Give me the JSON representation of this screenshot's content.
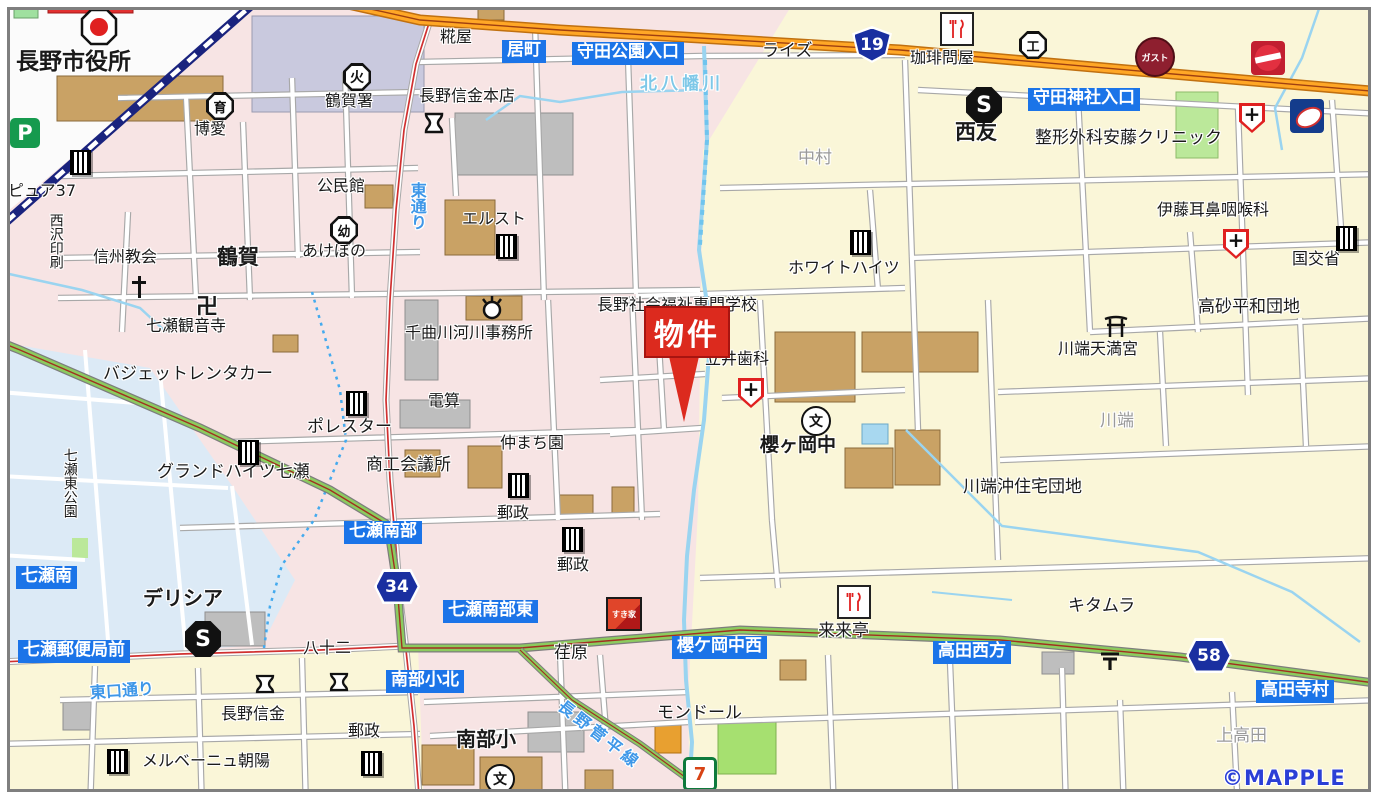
{
  "attribution": "©MAPPLE",
  "marker": {
    "label": "物件"
  },
  "colors": {
    "urban_pink": "#F7E4E4",
    "suburb_yellow": "#FAF6D8",
    "water_blue": "#DCEAF6",
    "park_green": "#BBE89A",
    "major_road_orange": "#FFA726",
    "green_road": "#8CCB5E",
    "badge_blue": "#1B74E8",
    "marker_red": "#DC2A1E",
    "river": "#9AD4F0"
  },
  "shields": {
    "r19": "19",
    "r34": "34",
    "r58": "58"
  },
  "badges": {
    "imachi": "居町",
    "morita_koen": "守田公園入口",
    "morita_jinja": "守田神社入口",
    "nanase_nanbu": "七瀬南部",
    "nanase_nanbu_higashi": "七瀬南部東",
    "nanbu_sho_kita": "南部小北",
    "nanase_minami": "七瀬南",
    "nanase_yubinkyoku_mae": "七瀬郵便局前",
    "sakuragaoka_nishi": "櫻ケ岡中西",
    "takada_seiho": "高田西方",
    "takada_teramura": "高田寺村"
  },
  "roads": {
    "higashi_dori": "東通り",
    "higashiguchi_dori": "東口通り",
    "sugadaira": "長野菅平線"
  },
  "river": {
    "kitahachiman": "北八幡川"
  },
  "areas": {
    "tsuruga": "鶴賀",
    "nakamura": "中村",
    "kawabata": "川端",
    "kamitakada": "上高田"
  },
  "places": {
    "nagano_shiyakusho": "長野市役所",
    "tsuruga_sho": "鶴賀署",
    "hakuai": "博愛",
    "kominkan": "公民館",
    "akebono": "あけぼの",
    "shinshu_kyokai": "信州教会",
    "nishizawa_insatsu": "西沢印刷",
    "nanase_kannonji": "七瀬観音寺",
    "kojiya": "糀屋",
    "shinkin_honten": "長野信金本店",
    "erusuto": "エルスト",
    "pure37": "ピュア37",
    "budget": "バジェットレンタカー",
    "polestar": "ポレスター",
    "grand_heights": "グランドハイツ七瀬",
    "shoko": "商工会議所",
    "chikuma": "千曲川河川事務所",
    "densan": "電算",
    "nakamachien": "仲まち園",
    "yusei": "郵政",
    "senmon": "長野社会福祉専門学校",
    "tatei": "立井歯科",
    "sakuragaoka_chu": "櫻ヶ岡中",
    "white_heights": "ホワイトハイツ",
    "rise": "ライズ",
    "coffee": "珈琲問屋",
    "seiyu": "西友",
    "ando": "整形外科安藤クリニック",
    "ito": "伊藤耳鼻咽喉科",
    "kokkosho": "国交省",
    "takasago": "高砂平和団地",
    "tenmangu": "川端天満宮",
    "kawabataoki": "川端沖住宅団地",
    "kitamura": "キタムラ",
    "rairaitei": "来来亭",
    "ebara": "荏原",
    "mondor": "モンドール",
    "nanbu_sho": "南部小",
    "nagano_shinkin": "長野信金",
    "merveille": "メルベーニュ朝陽",
    "delicia": "デリシア",
    "hachijuni": "八十二",
    "nanase_higashi_koen": "七瀬東公園"
  },
  "icon_glyphs": {
    "fire_station": "火",
    "nursery": "育",
    "kindergarten": "幼",
    "factory": "工",
    "school": "文",
    "temple": "卍",
    "supermarket": "S",
    "parking": "P",
    "seven_eleven": "7",
    "hospital_plus": "+",
    "gusto": "ガスト",
    "sukiya": "すき家"
  }
}
